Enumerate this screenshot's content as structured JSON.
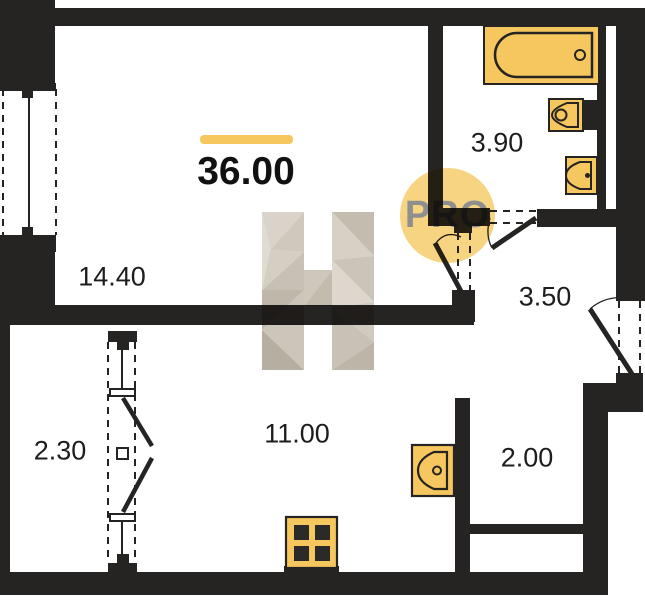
{
  "plan": {
    "total_area": "36.00",
    "badge_text": "PRO",
    "watermark_letter": "H",
    "rooms": [
      {
        "name": "living-room",
        "area": "14.40"
      },
      {
        "name": "bathroom",
        "area": "3.90"
      },
      {
        "name": "hallway",
        "area": "3.50"
      },
      {
        "name": "balcony",
        "area": "2.30"
      },
      {
        "name": "kitchen",
        "area": "11.00"
      },
      {
        "name": "storage",
        "area": "2.00"
      }
    ],
    "fixtures": [
      "bathtub",
      "toilet",
      "washbasin",
      "kitchen-sink",
      "stove"
    ],
    "colors": {
      "wall": "#262422",
      "fixture_fill": "#F6C75F",
      "accent_bar": "#F5C75E",
      "badge_fill": "#F6CE70",
      "badge_text": "#8F8F8F",
      "label_text": "#1D1D1B",
      "watermark_light": "#DDD7CD",
      "watermark_mid": "#CCC5B9",
      "watermark_dark": "#B8B1A4"
    }
  }
}
